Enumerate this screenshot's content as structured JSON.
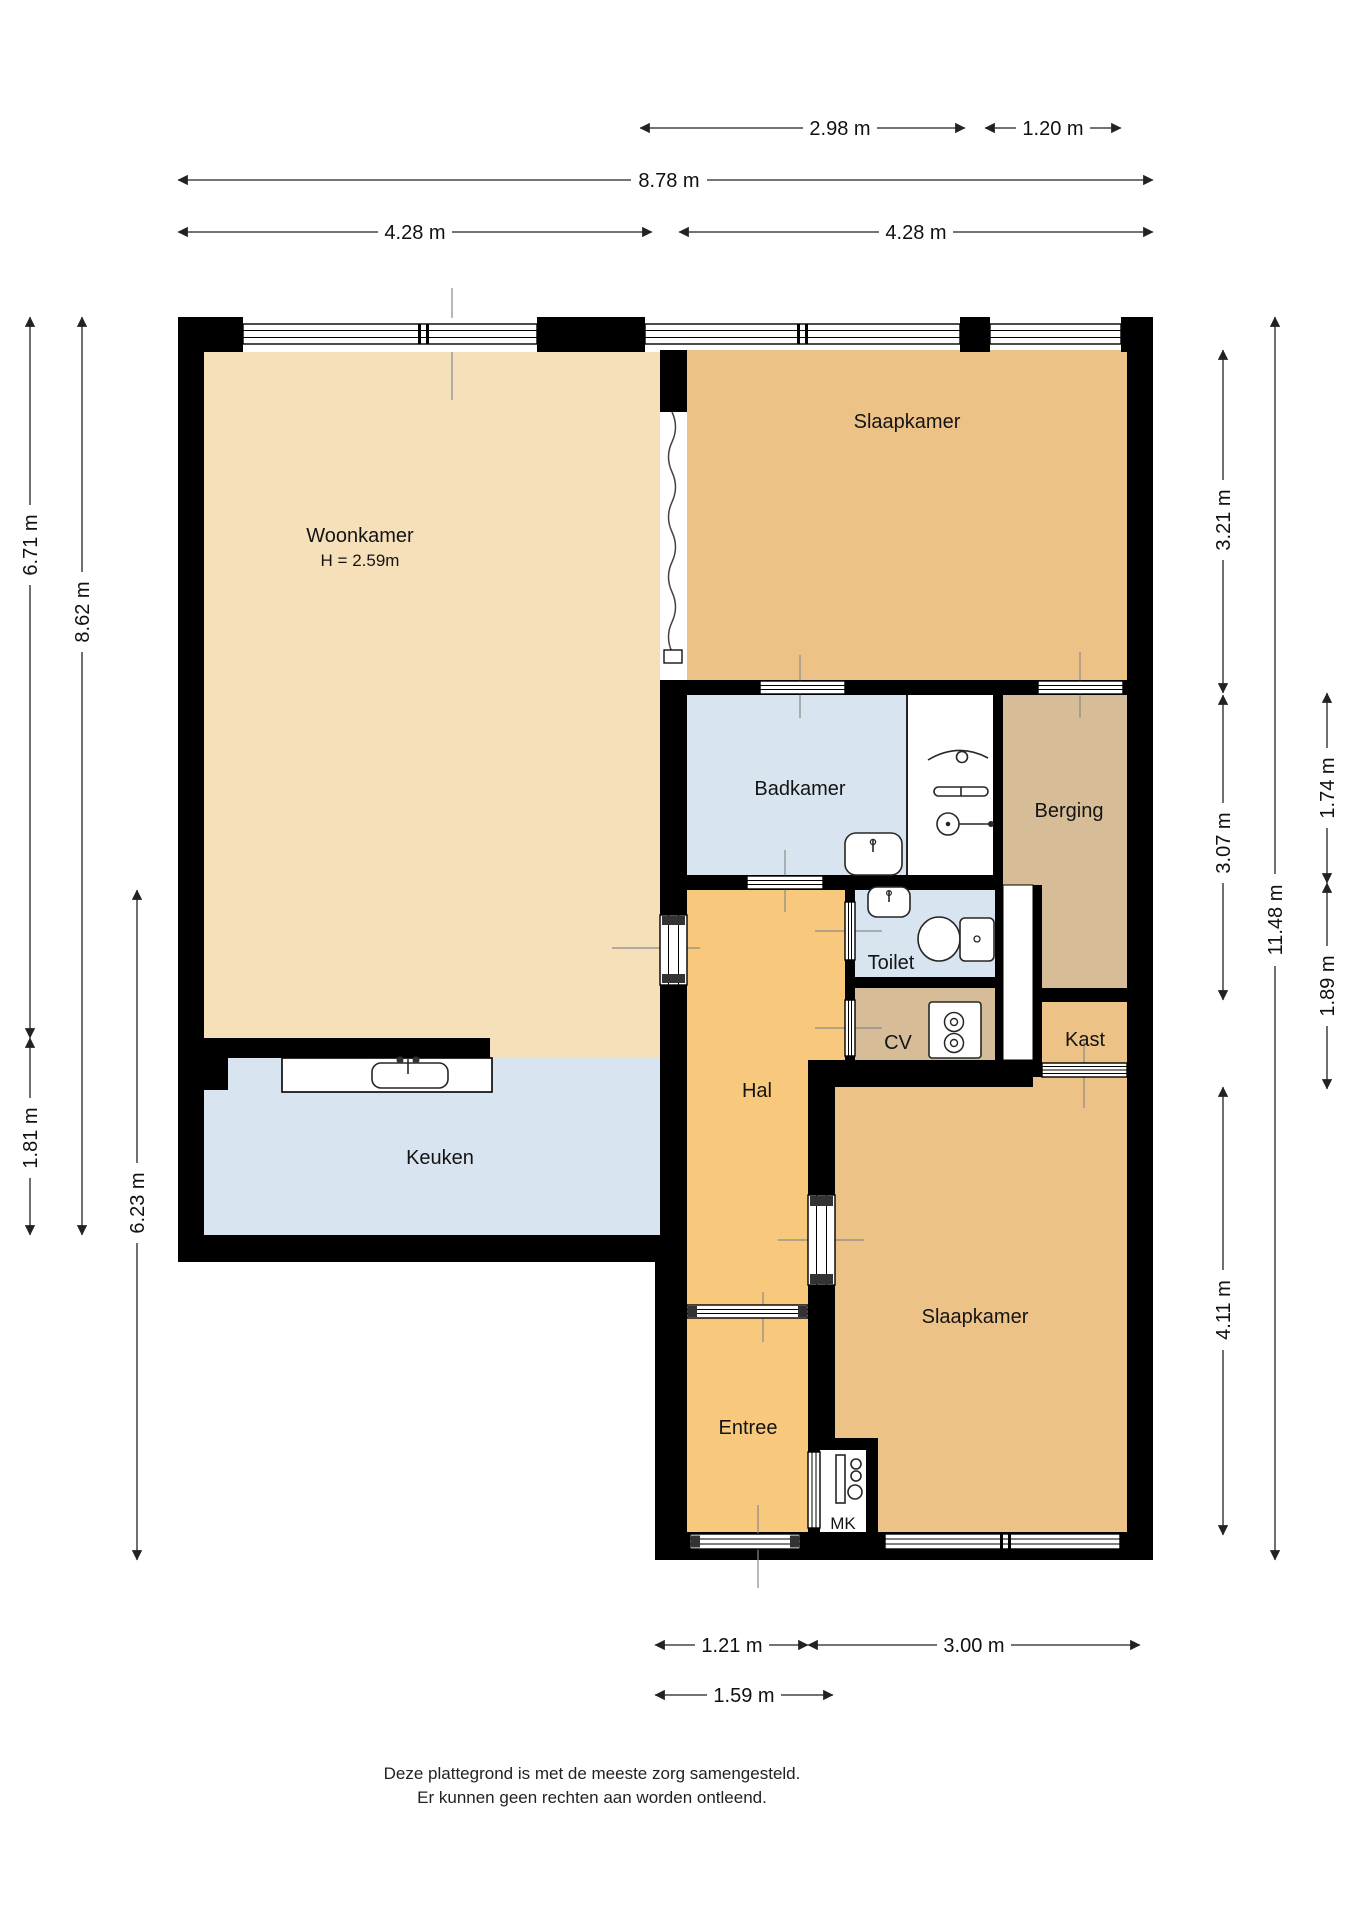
{
  "floorplan": {
    "rooms": {
      "woonkamer": {
        "label": "Woonkamer",
        "height_note": "H = 2.59m"
      },
      "slaapkamer_top": {
        "label": "Slaapkamer"
      },
      "badkamer": {
        "label": "Badkamer"
      },
      "berging": {
        "label": "Berging"
      },
      "toilet": {
        "label": "Toilet"
      },
      "cv": {
        "label": "CV"
      },
      "kast": {
        "label": "Kast"
      },
      "hal": {
        "label": "Hal"
      },
      "keuken": {
        "label": "Keuken"
      },
      "entree": {
        "label": "Entree"
      },
      "mk": {
        "label": "MK"
      },
      "slaapkamer_bottom": {
        "label": "Slaapkamer"
      }
    },
    "dimensions": {
      "top": [
        {
          "label": "2.98 m"
        },
        {
          "label": "1.20 m"
        },
        {
          "label": "8.78 m"
        },
        {
          "label": "4.28 m"
        },
        {
          "label": "4.28 m"
        }
      ],
      "left": [
        {
          "label": "6.71 m"
        },
        {
          "label": "8.62 m"
        },
        {
          "label": "1.81 m"
        },
        {
          "label": "6.23 m"
        }
      ],
      "right": [
        {
          "label": "3.21 m"
        },
        {
          "label": "1.74 m"
        },
        {
          "label": "3.07 m"
        },
        {
          "label": "11.48 m"
        },
        {
          "label": "1.89 m"
        },
        {
          "label": "4.11 m"
        }
      ],
      "bottom": [
        {
          "label": "1.21 m"
        },
        {
          "label": "3.00 m"
        },
        {
          "label": "1.59 m"
        }
      ]
    },
    "disclaimer": {
      "line1": "Deze plattegrond is met de meeste zorg samengesteld.",
      "line2": "Er kunnen geen rechten aan worden ontleend."
    },
    "colors": {
      "wall": "#000000",
      "woonkamer": "#f5e0ba",
      "slaapkamer": "#edc287",
      "hal_entree": "#f8c97c",
      "wet_rooms": "#d8e4f0",
      "berging_cv": "#d6bd98"
    }
  }
}
